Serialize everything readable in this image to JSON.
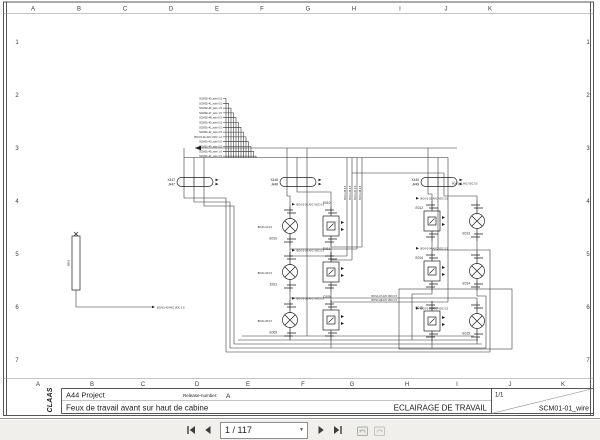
{
  "viewer": {
    "toolbar": {
      "page_value": "1 / 117",
      "icons": [
        "first-page",
        "previous-page",
        "page-number-combobox",
        "next-page",
        "last-page",
        "previous-view",
        "next-view"
      ]
    }
  },
  "drawing": {
    "ruler": {
      "letters": [
        "A",
        "B",
        "C",
        "D",
        "E",
        "F",
        "G",
        "H",
        "I",
        "J",
        "K"
      ],
      "numbers": [
        "1",
        "2",
        "3",
        "4",
        "5",
        "6",
        "7"
      ]
    },
    "logo_text": "CLAAS",
    "title_block": {
      "project": "A44 Project",
      "release_label": "Release-number:",
      "release_value": "A",
      "subtitle": "Feux de travail avant sur haut de cabine",
      "title": "ECLAIRAGE DE TRAVAIL",
      "sheet": "1/1",
      "code": "SCM01-01_wire"
    },
    "schematic": {
      "feed_labels": [
        "SCM02-40_wire 0.5",
        "SCM02-41_wire 0.5",
        "SCM02-46_wire 1.5",
        "SCM02-47_wire 1.5",
        "SCM02-48_wire 0.5",
        "SCM01-40_wire 0.5",
        "SCM01-41_wire 0.5",
        "SCM01-42_wire 2.5",
        "BO/V1-01 AVC VDC 1.4",
        "SCM01-43_wire 0.5",
        "SCM01-44_wire 0.5",
        "SCM01-45_wire 1.0",
        "SCM01-46_wire 0.5"
      ],
      "connectors": [
        {
          "x": "X447",
          "j": "J447"
        },
        {
          "x": "X448",
          "j": "J448"
        },
        {
          "x": "X449",
          "j": "J449"
        }
      ],
      "vertical_labels": [
        "BO/41-05 0.5",
        "BO/41-06 0.5",
        "BO/41-07 0.5",
        "BO/41-08 0.5"
      ],
      "exit_labels": [
        "BO/V1-07 AVC VDC 0.5",
        "BO/V1-08 AVC VDC 0.5"
      ],
      "splice": {
        "id": "XB01",
        "wire_label": "BO/V1-40 AVC VDC 1.5"
      },
      "clusters": {
        "ul": {
          "lamp": "E010",
          "module": "E010",
          "wire": "BO/V1-01 AVC VDC 0.5",
          "side": "BO/41-01 0.5"
        },
        "ml": {
          "lamp": "E011",
          "module": "E011",
          "wire": "BO/V1-03 AVC VDC 0.5",
          "side": "BO/41-03 0.5"
        },
        "bl": {
          "lamp": "E009",
          "module": "C009",
          "wire": "BO/V1-05 AVC VDC 0.5",
          "side": "BO/41-05 0.5"
        },
        "ur": {
          "module": "E012",
          "lamp": "E013",
          "wire": "BO/V1-02 AVC VDC 0.5",
          "wire2": "BO/V1-41 AVC VDC 0.5"
        },
        "mr": {
          "module": "E014",
          "lamp": "E014",
          "wire": "BO/V1-04 AVC VDC 0.5"
        },
        "br": {
          "module": "E015",
          "lamp": "E015",
          "wire": "BO/V1-06 AVC VDC 0.5"
        }
      }
    }
  }
}
